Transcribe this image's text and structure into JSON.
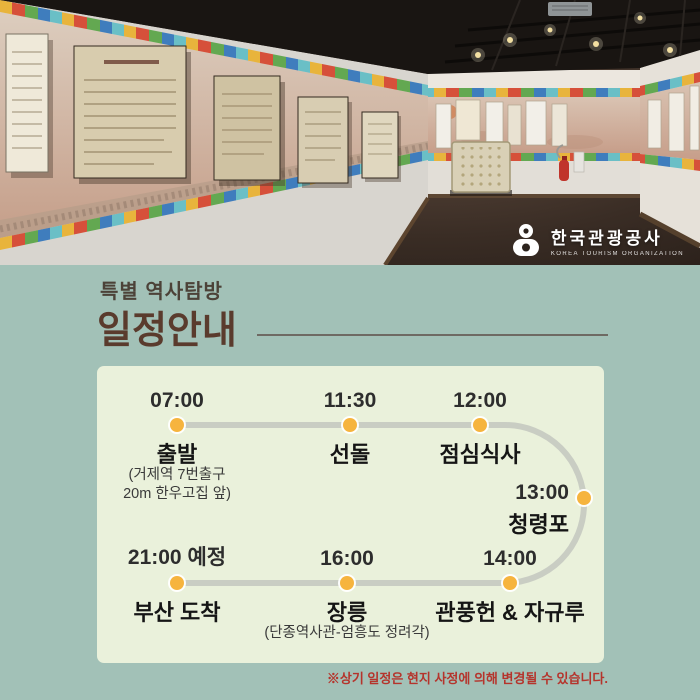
{
  "theme": {
    "bg": "#a2c1b7",
    "card-bg": "#eaf1db",
    "title-brown": "#5a3b2d",
    "subtitle-col": "#4c4238",
    "divider": "#6e6a63",
    "dot": "#f6b43e",
    "line": "#c9cdc3",
    "time-col": "#2d2d2d",
    "name-col": "#151515",
    "note-col": "#3a3a3a",
    "red": "#b5342c"
  },
  "photo": {
    "logo": {
      "name": "한국관광공사",
      "subtitle": "KOREA TOURISM ORGANIZATION"
    }
  },
  "header": {
    "subtitle": "특별 역사탐방",
    "title": "일정안내"
  },
  "timeline": {
    "stops": [
      {
        "time": "07:00",
        "name": "출발",
        "note": "(거제역 7번출구\n20m 한우고집 앞)"
      },
      {
        "time": "11:30",
        "name": "선돌"
      },
      {
        "time": "12:00",
        "name": "점심식사"
      },
      {
        "time": "13:00",
        "name": "청령포"
      },
      {
        "time": "14:00",
        "name": "관풍헌 & 자규루"
      },
      {
        "time": "16:00",
        "name": "장릉",
        "note": "(단종역사관-엄흥도 정려각)"
      },
      {
        "time": "21:00 예정",
        "name": "부산 도착"
      }
    ]
  },
  "footnote": "※상기 일정은 현지 사정에 의해 변경될 수 있습니다."
}
